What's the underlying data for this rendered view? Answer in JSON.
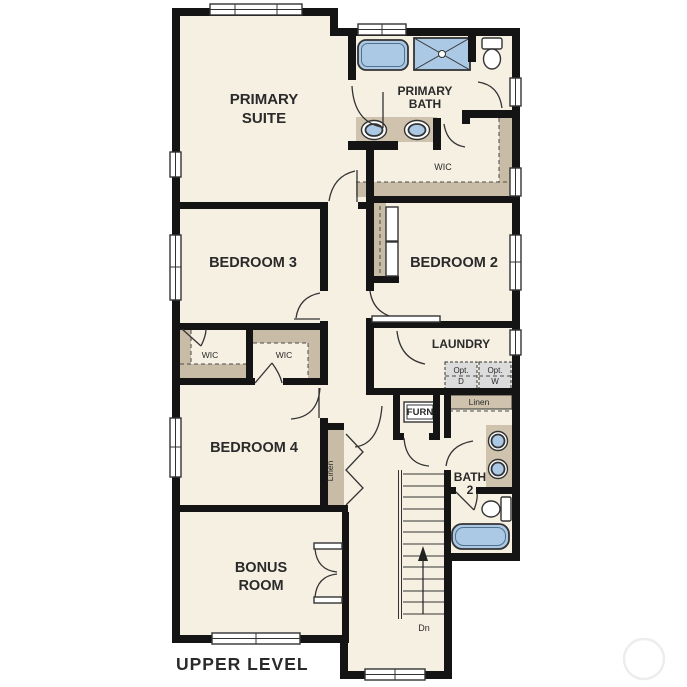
{
  "floor_plan": {
    "title": "UPPER LEVEL",
    "level_label": "UPPER LEVEL",
    "stair_direction": "Dn",
    "colors": {
      "wall": "#141414",
      "floor": "#f6f0e3",
      "fixture": "#abc9e5",
      "counter": "#cfc3ad",
      "closet": "#c8bca6",
      "optional": "#dcdcdc",
      "text": "#2a2a2a",
      "watermark": "#ededed"
    },
    "rooms": [
      "PRIMARY SUITE",
      "PRIMARY BATH",
      "WIC",
      "BEDROOM 3",
      "BEDROOM 2",
      "WIC",
      "WIC",
      "LAUNDRY",
      "BEDROOM 4",
      "BATH 2",
      "BONUS ROOM"
    ],
    "labels": [
      {
        "id": "primary-suite",
        "lines": [
          "PRIMARY",
          "SUITE"
        ],
        "x": 264,
        "y": 104,
        "size": 15,
        "bold": true,
        "lh": 19
      },
      {
        "id": "primary-bath",
        "lines": [
          "PRIMARY",
          "BATH"
        ],
        "x": 425,
        "y": 95,
        "size": 12,
        "bold": true,
        "lh": 13
      },
      {
        "id": "wic-primary",
        "lines": [
          "WIC"
        ],
        "x": 443,
        "y": 170,
        "size": 9,
        "bold": false
      },
      {
        "id": "bedroom-3",
        "lines": [
          "BEDROOM 3"
        ],
        "x": 253,
        "y": 267,
        "size": 14.5,
        "bold": true
      },
      {
        "id": "bedroom-2",
        "lines": [
          "BEDROOM 2"
        ],
        "x": 454,
        "y": 267,
        "size": 14.5,
        "bold": true
      },
      {
        "id": "wic-1",
        "lines": [
          "WIC"
        ],
        "x": 210,
        "y": 358,
        "size": 8.5,
        "bold": false
      },
      {
        "id": "wic-2",
        "lines": [
          "WIC"
        ],
        "x": 284,
        "y": 358,
        "size": 8.5,
        "bold": false
      },
      {
        "id": "laundry",
        "lines": [
          "LAUNDRY"
        ],
        "x": 461,
        "y": 348,
        "size": 12,
        "bold": true
      },
      {
        "id": "opt-dryer",
        "lines": [
          "Opt.",
          "D"
        ],
        "x": 461,
        "y": 373,
        "size": 8,
        "bold": false,
        "lh": 11
      },
      {
        "id": "opt-washer",
        "lines": [
          "Opt.",
          "W"
        ],
        "x": 495,
        "y": 373,
        "size": 8,
        "bold": false,
        "lh": 11
      },
      {
        "id": "linen-laundry",
        "lines": [
          "Linen"
        ],
        "x": 479,
        "y": 405,
        "size": 8.5,
        "bold": false
      },
      {
        "id": "furnace",
        "lines": [
          "FURN"
        ],
        "x": 420,
        "y": 415,
        "size": 9.5,
        "bold": true
      },
      {
        "id": "bedroom-4",
        "lines": [
          "BEDROOM 4"
        ],
        "x": 254,
        "y": 452,
        "size": 14.5,
        "bold": true
      },
      {
        "id": "linen-closet",
        "lines": [
          "Linen"
        ],
        "x": 333,
        "y": 471,
        "size": 8.5,
        "bold": false,
        "rotate": -90
      },
      {
        "id": "bath-2",
        "lines": [
          "BATH",
          "2"
        ],
        "x": 470,
        "y": 481,
        "size": 12,
        "bold": true,
        "lh": 13
      },
      {
        "id": "bonus-room",
        "lines": [
          "BONUS",
          "ROOM"
        ],
        "x": 261,
        "y": 572,
        "size": 14.5,
        "bold": true,
        "lh": 18
      },
      {
        "id": "stairs-down",
        "lines": [
          "Dn"
        ],
        "x": 424,
        "y": 631,
        "size": 9,
        "bold": false
      },
      {
        "id": "upper-level",
        "lines": [
          "UPPER LEVEL"
        ],
        "x": 176,
        "y": 670,
        "size": 17.5,
        "bold": true,
        "anchor": "start",
        "spacing": 1
      }
    ]
  }
}
